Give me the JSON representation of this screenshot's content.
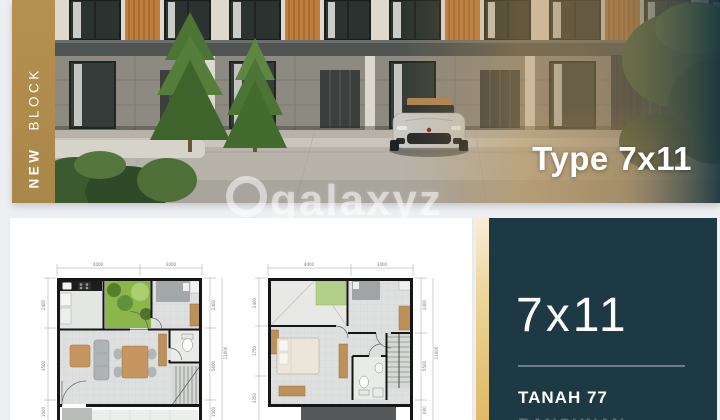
{
  "hero": {
    "badge": {
      "word_bold": "NEW",
      "word_light": "BLOCK",
      "bg_color": "#ae8c50"
    },
    "type_label": "Type 7x11",
    "watermark_text": "galaxyz"
  },
  "info_panel": {
    "size_label": "7x11",
    "land_label": "TANAH 77",
    "building_label_partial": "BANGUNAN",
    "bg_color": "#1d3a44",
    "stripe_gold_color": "#e7c87e"
  },
  "floor_plans": {
    "plan1": {
      "dims_top": [
        "4000",
        "3000"
      ],
      "dims_left": [
        "2400",
        "3500",
        "1500"
      ],
      "dims_right": [
        "2400",
        "5600",
        "1500"
      ],
      "dim_total": "11000"
    },
    "plan2": {
      "dims_top": [
        "4000",
        "3000"
      ],
      "dims_left": [
        "2400",
        "1750",
        "3350"
      ],
      "dims_right": [
        "2400",
        "5500",
        "600"
      ],
      "dim_total": "11000"
    }
  }
}
